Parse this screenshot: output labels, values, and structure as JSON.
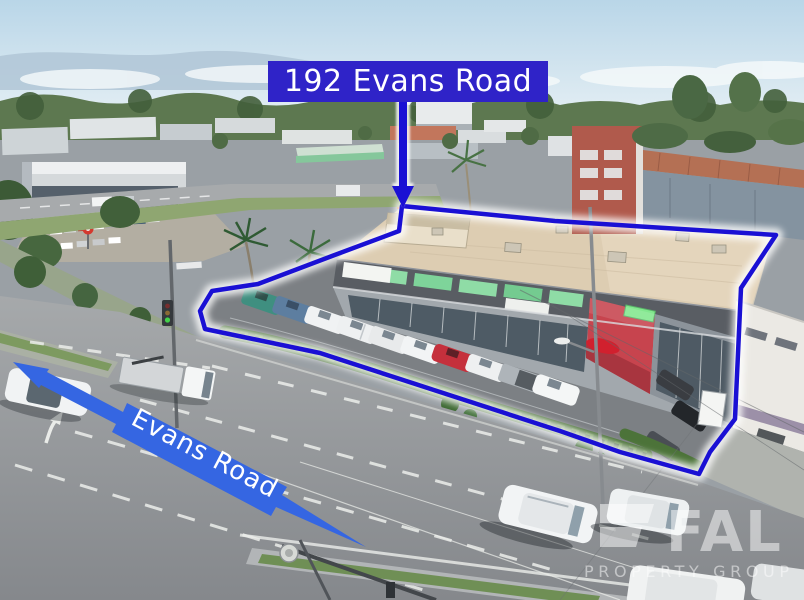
{
  "annotations": {
    "address_label": "192 Evans Road",
    "road_label": "Evans Road"
  },
  "watermark": {
    "brand": "FAL",
    "tagline": "PROPERTY GROUP"
  },
  "colors": {
    "label_bg": "#2f23c8",
    "outline_blue": "#1a10d4",
    "arrow_blue": "#3566e2",
    "text_white": "#ffffff"
  }
}
